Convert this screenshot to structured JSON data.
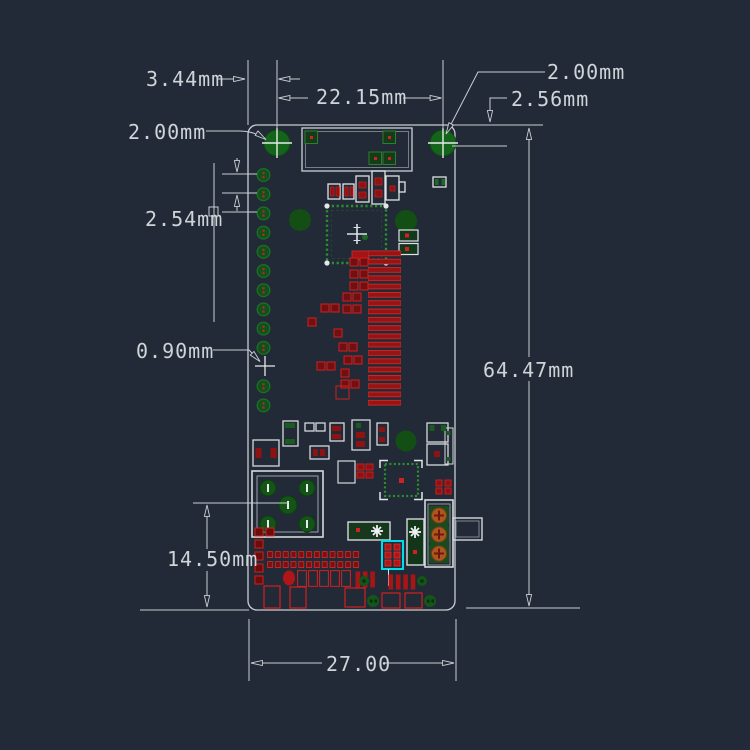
{
  "meta": {
    "description": "PCB dimensional drawing, dark CAD style, board 27.00 x 64.47mm",
    "units": "mm"
  },
  "colors": {
    "background": "#212a36",
    "dimension_lines": "#c9ced3",
    "dimension_text": "#cfd4d8",
    "silkscreen_white": "#dde1e4",
    "pad_green_dark": "#15641b",
    "pad_green_bright": "#2c8f31",
    "pad_red": "#cf2020",
    "pad_red_fill": "#8e1212",
    "switch_pad_orange": "#a85a1e",
    "selection_highlight": "#00dcec"
  },
  "dims": {
    "d344": {
      "label": "3.44mm"
    },
    "d2215": {
      "label": "22.15mm"
    },
    "d200l": {
      "label": "2.00mm"
    },
    "d200r": {
      "label": "2.00mm"
    },
    "d256": {
      "label": "2.56mm"
    },
    "d254": {
      "label": "2.54mm"
    },
    "d090": {
      "label": "0.90mm"
    },
    "d6447": {
      "label": "64.47mm"
    },
    "d1450": {
      "label": "14.50mm"
    },
    "d2700": {
      "label": "27.00"
    }
  }
}
